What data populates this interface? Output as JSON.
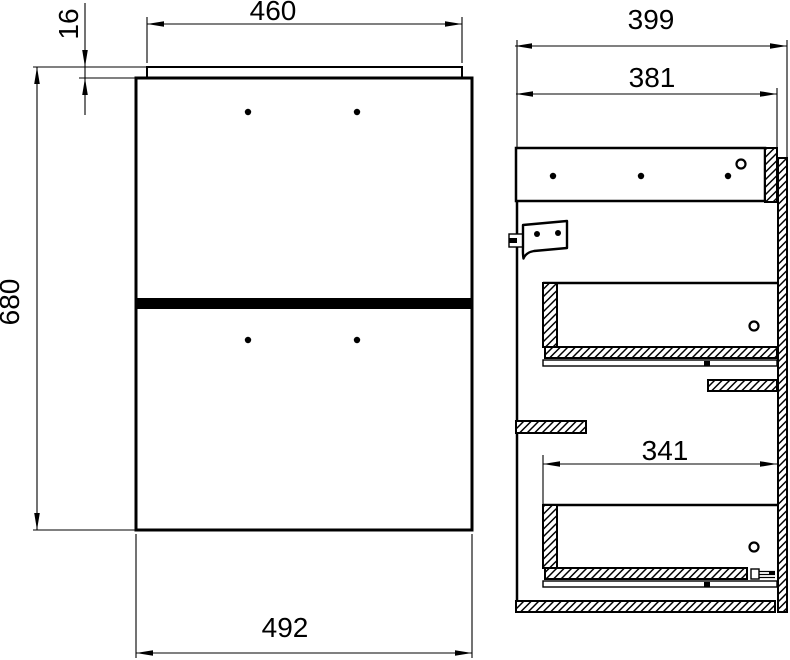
{
  "drawing": {
    "type": "furniture-technical-drawing",
    "views": {
      "front": {
        "name": "front-view",
        "dims": {
          "top_panel_width": "460",
          "top_panel_thickness": "16",
          "overall_height": "680",
          "front_width": "492"
        }
      },
      "side": {
        "name": "side-view",
        "dims": {
          "overall_depth": "399",
          "carcass_depth": "381",
          "drawer_inner_depth": "341"
        }
      }
    },
    "colors": {
      "line": "#000000",
      "background": "#ffffff"
    }
  }
}
